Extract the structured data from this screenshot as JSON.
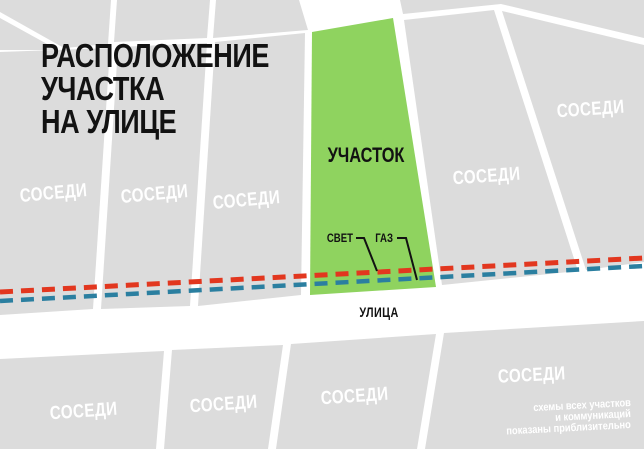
{
  "title": {
    "line1": "РАСПОЛОЖЕНИЕ",
    "line2": "УЧАСТКА",
    "line3": "НА УЛИЦЕ"
  },
  "map": {
    "plot_label": "УЧАСТОК",
    "neighbor_label": "СОСЕДИ",
    "street_label": "УЛИЦА",
    "utilities": {
      "electricity_label": "СВЕТ",
      "gas_label": "ГАЗ"
    },
    "colors": {
      "plot_green": "#8fd35f",
      "electricity_red": "#e2371f",
      "gas_blue": "#2b7fa0",
      "neighbor_gray": "#dcdcdc",
      "street_white": "#ffffff"
    }
  },
  "disclaimer": {
    "line1": "схемы всех участков",
    "line2": "и коммуникаций",
    "line3": "показаны приблизительно"
  }
}
